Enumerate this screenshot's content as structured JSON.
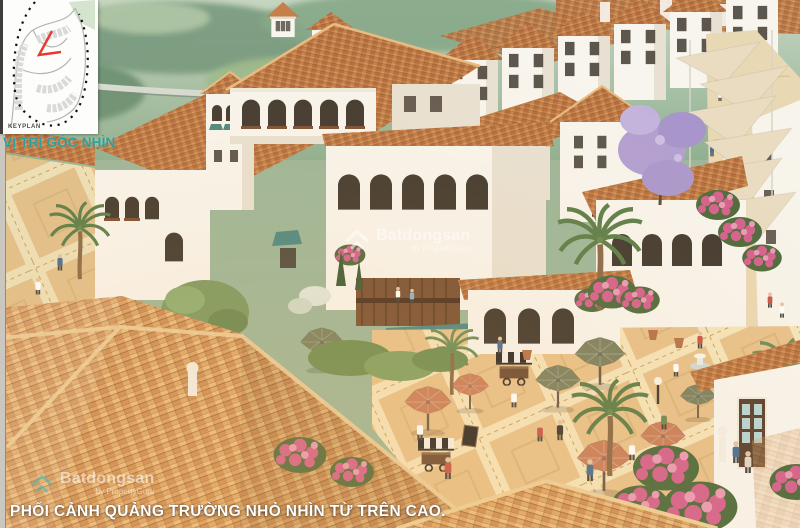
{
  "scene": {
    "description": "Aerial 3D architectural rendering of a Mediterranean-style shophouse village: white stucco buildings with terracotta tile roofs, a small cafe plaza with umbrellas and palm trees, and a pedestrian street shaded by fabric sails, green hills in the background",
    "caption": "PHỐI CẢNH QUẢNG TRƯỜNG NHỎ NHÌN TỪ TRÊN CAO."
  },
  "keyplan": {
    "label": "KEYPLAN",
    "view_position_label": "VỊ TRÍ GÓC NHÌN"
  },
  "watermark": {
    "brand": "Batdongsan",
    "byline": "by PropertyGuru"
  },
  "palette": {
    "teal_label": "#2aa19b",
    "keyplan_marker_red": "#e8392b",
    "caption_white": "#ffffff",
    "wall_white": "#f8f5ee",
    "wall_shade": "#e8e1d3",
    "window_dark": "#433b31",
    "roof_tile": "#c57f4a",
    "roof_tile_light": "#e0a66b",
    "roof_tile_dark": "#a05d33",
    "roof_foreground": "#dfa868",
    "paving_tan": "#e7c28c",
    "paving_cream": "#f4e4bc",
    "street_sand": "#e9d8b4",
    "shade_sail": "#e9dcc1",
    "hills_green": "#8fb092",
    "hills_dark_green": "#6f9377",
    "palm_green": "#5d7e4b",
    "bougainvillea_pink": "#d4628e",
    "jacaranda_purple": "#b3a0d2",
    "umbrella_salmon": "#c97f5c",
    "umbrella_olive": "#7c8161",
    "awning_teal": "#4e8984",
    "wood_brown": "#7a5236"
  }
}
